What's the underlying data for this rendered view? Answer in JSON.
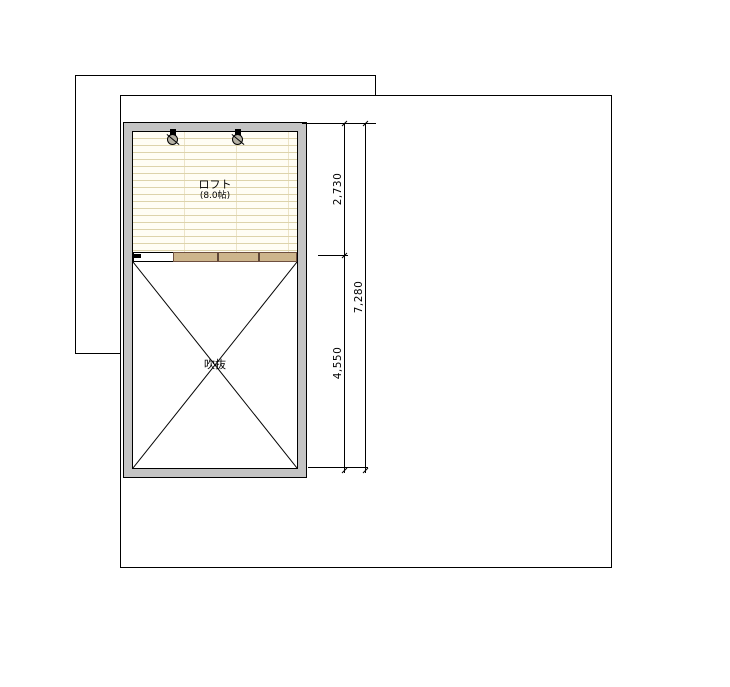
{
  "plan": {
    "loft": {
      "name": "ロフト",
      "size": "(8.0帖)"
    },
    "void": {
      "name": "吹抜"
    }
  },
  "dimensions": {
    "right_segments": [
      "2,730",
      "4,550"
    ],
    "right_total": "7,280"
  },
  "fixtures": {
    "ceiling_lights_count": 2
  },
  "colors": {
    "line": "#000000",
    "wall_fill": "#c4c4c4",
    "floor_bg": "#fffdf4",
    "floor_line": "#ddd3ab",
    "railing_fill": "#cdb58c",
    "railing_border": "#6e4f3f",
    "light_fill": "#b5b1a4"
  }
}
